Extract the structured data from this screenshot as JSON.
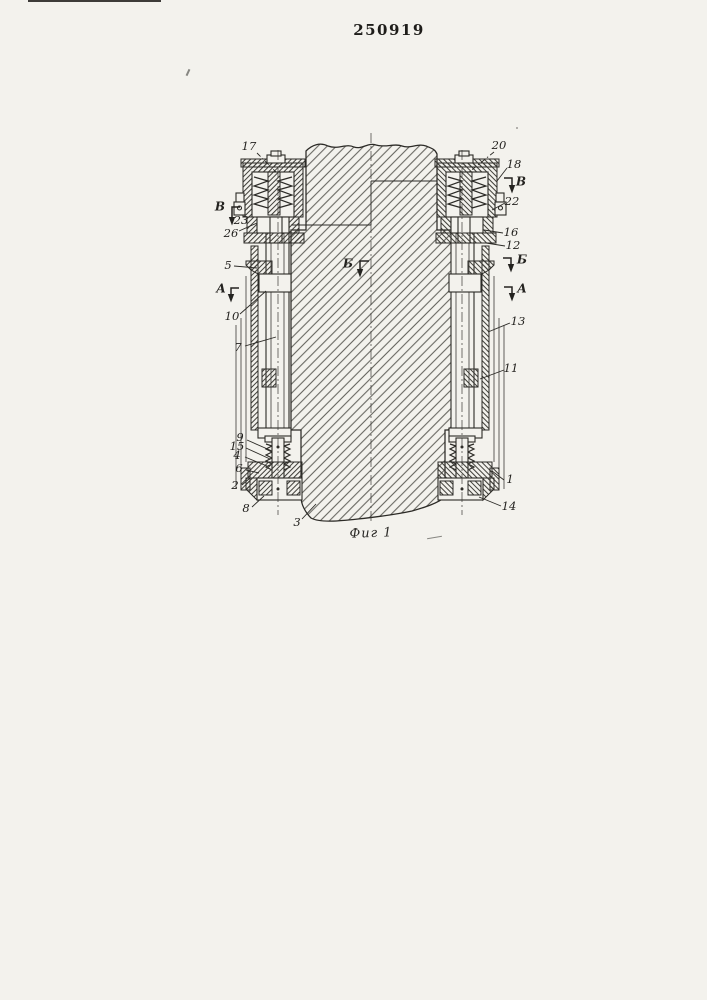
{
  "document": {
    "patent_number": "250919",
    "figure_caption": "Фиг 1"
  },
  "colors": {
    "paper": "#f3f2ed",
    "ink": "#2b2a26"
  },
  "drawing": {
    "section_markers": [
      {
        "letter": "В",
        "tx": 220,
        "ty": 207,
        "path": [
          [
            240,
            207
          ],
          [
            232,
            207
          ],
          [
            232,
            217
          ]
        ]
      },
      {
        "letter": "В",
        "tx": 521,
        "ty": 182,
        "path": [
          [
            504,
            178
          ],
          [
            512,
            178
          ],
          [
            512,
            185
          ]
        ]
      },
      {
        "letter": "А",
        "tx": 221,
        "ty": 289,
        "path": [
          [
            239,
            288
          ],
          [
            231,
            288
          ],
          [
            231,
            294
          ]
        ]
      },
      {
        "letter": "А",
        "tx": 522,
        "ty": 289,
        "path": [
          [
            504,
            287
          ],
          [
            512,
            287
          ],
          [
            512,
            293
          ]
        ]
      },
      {
        "letter": "Б",
        "tx": 522,
        "ty": 260,
        "path": [
          [
            503,
            258
          ],
          [
            511,
            258
          ],
          [
            511,
            264
          ]
        ]
      },
      {
        "letter": "Б",
        "tx": 348,
        "ty": 264,
        "path": [
          [
            369,
            261
          ],
          [
            360,
            261
          ],
          [
            360,
            269
          ]
        ]
      }
    ],
    "callouts": [
      {
        "label": "17",
        "tx": 249,
        "ty": 147,
        "leader": [
          257,
          153,
          276,
          172
        ],
        "dashed": true
      },
      {
        "label": "23",
        "tx": 241,
        "ty": 221,
        "leader": null
      },
      {
        "label": "26",
        "tx": 231,
        "ty": 234,
        "leader": [
          239,
          231,
          257,
          223
        ]
      },
      {
        "label": "5",
        "tx": 228,
        "ty": 266,
        "leader": [
          234,
          266,
          257,
          268
        ]
      },
      {
        "label": "10",
        "tx": 232,
        "ty": 317,
        "leader": [
          240,
          314,
          266,
          291
        ]
      },
      {
        "label": "7",
        "tx": 238,
        "ty": 348,
        "leader": [
          245,
          346,
          276,
          337
        ]
      },
      {
        "label": "9",
        "tx": 240,
        "ty": 438,
        "leader": [
          247,
          440,
          272,
          451
        ]
      },
      {
        "label": "15",
        "tx": 237,
        "ty": 447,
        "leader": [
          246,
          448,
          270,
          459
        ]
      },
      {
        "label": "4",
        "tx": 237,
        "ty": 456,
        "leader": [
          245,
          457,
          267,
          466
        ]
      },
      {
        "label": "6",
        "tx": 239,
        "ty": 469,
        "leader": [
          246,
          470,
          259,
          473
        ]
      },
      {
        "label": "2",
        "tx": 235,
        "ty": 486,
        "leader": [
          242,
          485,
          250,
          478
        ]
      },
      {
        "label": "8",
        "tx": 246,
        "ty": 509,
        "leader": [
          252,
          507,
          264,
          496
        ]
      },
      {
        "label": "3",
        "tx": 297,
        "ty": 523,
        "leader": [
          302,
          519,
          316,
          504
        ]
      },
      {
        "label": "20",
        "tx": 499,
        "ty": 146,
        "leader": [
          494,
          152,
          468,
          173
        ],
        "dashed": true
      },
      {
        "label": "18",
        "tx": 514,
        "ty": 165,
        "leader": [
          507,
          168,
          497,
          181
        ]
      },
      {
        "label": "22",
        "tx": 512,
        "ty": 202,
        "leader": [
          505,
          203,
          492,
          210
        ]
      },
      {
        "label": "16",
        "tx": 511,
        "ty": 233,
        "leader": [
          503,
          233,
          484,
          230
        ]
      },
      {
        "label": "12",
        "tx": 513,
        "ty": 246,
        "leader": [
          505,
          246,
          486,
          243
        ]
      },
      {
        "label": "13",
        "tx": 518,
        "ty": 322,
        "leader": [
          510,
          323,
          488,
          332
        ]
      },
      {
        "label": "11",
        "tx": 511,
        "ty": 369,
        "leader": [
          504,
          370,
          480,
          379
        ]
      },
      {
        "label": "1",
        "tx": 510,
        "ty": 480,
        "leader": [
          504,
          480,
          492,
          471
        ]
      },
      {
        "label": "14",
        "tx": 509,
        "ty": 507,
        "leader": [
          501,
          506,
          479,
          497
        ]
      }
    ]
  }
}
